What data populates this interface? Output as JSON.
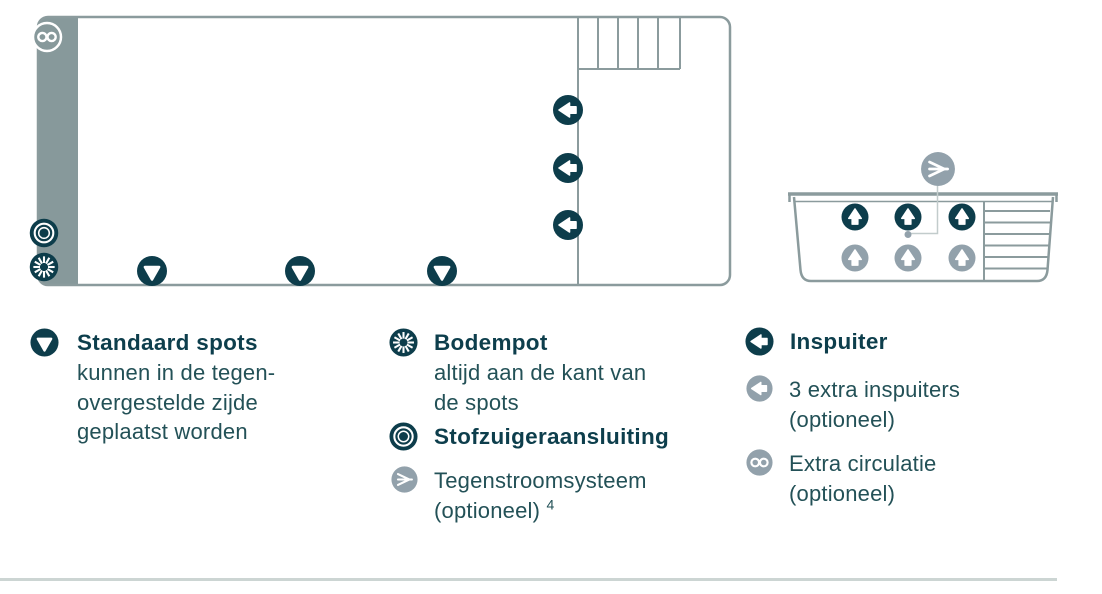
{
  "legend": {
    "standaard_spots": {
      "title": "Standaard spots",
      "lines": [
        "kunnen in de tegen-",
        "overgestelde zijde",
        "geplaatst worden"
      ]
    },
    "bodempot": {
      "title": "Bodempot",
      "lines": [
        "altijd aan de kant van",
        "de spots"
      ]
    },
    "stofzuigeraansluiting": {
      "title": "Stofzuigeraansluiting"
    },
    "tegenstroomsysteem": {
      "line1": "Tegenstroomsysteem",
      "line2": "(optioneel)",
      "superscript": "4"
    },
    "inspuiter": {
      "title": "Inspuiter"
    },
    "extra_inspuiters": {
      "lines": [
        "3 extra inspuiters",
        "(optioneel)"
      ]
    },
    "extra_circulatie": {
      "lines": [
        "Extra circulatie",
        "(optioneel)"
      ]
    }
  },
  "icons": {
    "standard_spot": "dark-circle-down-arrow",
    "inspuiter": "dark-circle-left-arrow",
    "extra_inspuiter": "gray-circle-left-arrow",
    "bodempot": "dark-circle-sunburst",
    "stofzuigeraansluiting": "dark-circle-target-rings",
    "tegenstroom": "gray-circle-jet-arrow",
    "extra_circulatie": "gray-circle-infinity",
    "up_jet_dark": "dark-circle-up-arrow",
    "up_jet_gray": "gray-circle-up-arrow"
  },
  "colors": {
    "dark_teal": "#0d3d4b",
    "muted_gray": "#92a1ab",
    "wall_band": "#87999b",
    "pool_outline": "#8b9b9d",
    "body_text": "#235157",
    "title_text": "#0d3e4c",
    "divider": "#ccd5d3",
    "connector": "#c2cccc"
  }
}
